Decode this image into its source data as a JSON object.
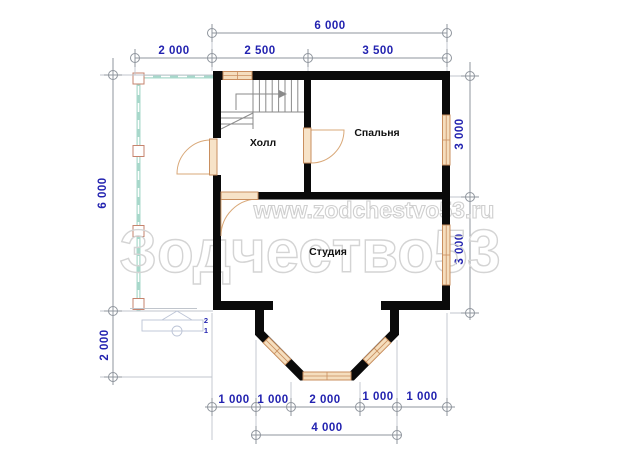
{
  "watermark": {
    "url": "www.zodchestvo53.ru",
    "brand": "Зодчество53"
  },
  "rooms": {
    "hall": "Холл",
    "bedroom": "Спальня",
    "studio": "Студия"
  },
  "dims": {
    "top_overall": "6 000",
    "top_seg_1": "2 000",
    "top_seg_2": "2 500",
    "top_seg_3": "3 500",
    "left_main": "6 000",
    "left_lower": "2 000",
    "right_upper": "3 000",
    "right_lower": "3 000",
    "bot_1": "1 000",
    "bot_2": "1 000",
    "bot_3": "2 000",
    "bot_4": "1 000",
    "bot_5": "1 000",
    "bot_overall": "4 000"
  },
  "step_marks": {
    "upper": "2",
    "lower": "1"
  },
  "colors": {
    "dimension_text": "#2323b0",
    "dimension_line": "#8f959d",
    "wall": "#0a0a0a",
    "window_fill": "#f5debe",
    "window_stroke": "#c98f5f",
    "porch": "#a8d8cb",
    "watermark": "#d2d2d2"
  }
}
